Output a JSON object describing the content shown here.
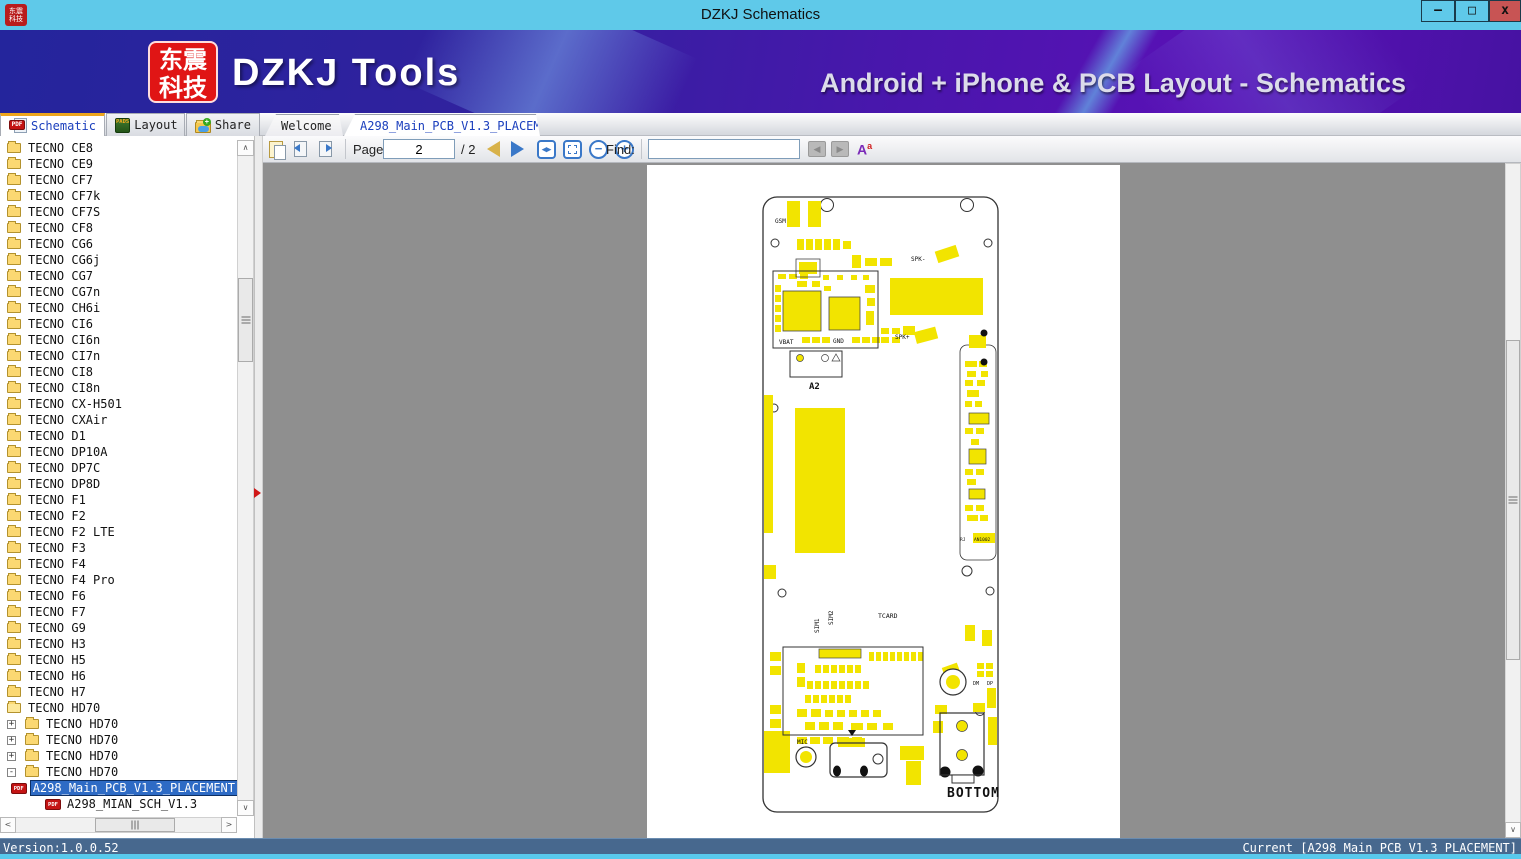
{
  "window": {
    "title": "DZKJ Schematics",
    "logo_line1": "东震",
    "logo_line2": "科技",
    "controls": {
      "minimize": "–",
      "maximize": "□",
      "close": "x"
    }
  },
  "banner": {
    "logo_line1": "东震",
    "logo_line2": "科技",
    "product": "DZKJ Tools",
    "tagline": "Android + iPhone & PCB Layout - Schematics"
  },
  "main_tabs": [
    {
      "label": "Schematic",
      "icon": "pdf-icon",
      "active": true
    },
    {
      "label": "Layout",
      "icon": "pads-icon",
      "active": false
    },
    {
      "label": "Share",
      "icon": "share-folder-icon",
      "active": false
    }
  ],
  "doc_tabs": [
    {
      "label": "Welcome",
      "active": false
    },
    {
      "label": "A298_Main_PCB_V1.3_PLACEMENT",
      "active": true,
      "close_glyph": "×"
    }
  ],
  "toolbar": {
    "page_label": "Page:",
    "page_value": "2",
    "page_total": "/ 2",
    "fit_width_glyph": "◂▸",
    "zoom_out_glyph": "−",
    "zoom_in_glyph": "+",
    "find_label": "Find:",
    "find_value": "",
    "font_glyph": "A",
    "font_sup_glyph": "a"
  },
  "sidebar": {
    "tree": [
      {
        "label": "TECNO CE8"
      },
      {
        "label": "TECNO CE9"
      },
      {
        "label": "TECNO CF7"
      },
      {
        "label": "TECNO CF7k"
      },
      {
        "label": "TECNO CF7S"
      },
      {
        "label": "TECNO CF8"
      },
      {
        "label": "TECNO CG6"
      },
      {
        "label": "TECNO CG6j"
      },
      {
        "label": "TECNO CG7"
      },
      {
        "label": "TECNO CG7n"
      },
      {
        "label": "TECNO CH6i"
      },
      {
        "label": "TECNO CI6"
      },
      {
        "label": "TECNO CI6n"
      },
      {
        "label": "TECNO CI7n"
      },
      {
        "label": "TECNO CI8"
      },
      {
        "label": "TECNO CI8n"
      },
      {
        "label": "TECNO CX-H501"
      },
      {
        "label": "TECNO CXAir"
      },
      {
        "label": "TECNO D1"
      },
      {
        "label": "TECNO DP10A"
      },
      {
        "label": "TECNO DP7C"
      },
      {
        "label": "TECNO DP8D"
      },
      {
        "label": "TECNO F1"
      },
      {
        "label": "TECNO F2"
      },
      {
        "label": "TECNO F2 LTE"
      },
      {
        "label": "TECNO F3"
      },
      {
        "label": "TECNO F4"
      },
      {
        "label": "TECNO F4 Pro"
      },
      {
        "label": "TECNO F6"
      },
      {
        "label": "TECNO F7"
      },
      {
        "label": "TECNO G9"
      },
      {
        "label": "TECNO H3"
      },
      {
        "label": "TECNO H5"
      },
      {
        "label": "TECNO H6"
      },
      {
        "label": "TECNO H7"
      },
      {
        "label": "TECNO HD70",
        "open": true
      },
      {
        "label": "TECNO HD70",
        "level": 1,
        "expander": "+"
      },
      {
        "label": "TECNO HD70",
        "level": 1,
        "expander": "+"
      },
      {
        "label": "TECNO HD70",
        "level": 1,
        "expander": "+"
      },
      {
        "label": "TECNO HD70",
        "level": 1,
        "expander": "-"
      },
      {
        "label": "A298_Main_PCB_V1.3_PLACEMENT",
        "level": 2,
        "type": "pdf",
        "selected": true
      },
      {
        "label": "A298_MIAN_SCH_V1.3",
        "level": 2,
        "type": "pdf"
      }
    ]
  },
  "pcb": {
    "labels": {
      "gsm": "GSM",
      "spk_minus": "SPK-",
      "spk_plus": "SPK+",
      "vbat": "VBAT",
      "gnd": "GND",
      "a2": "A2",
      "an1002": "AN1002",
      "rj": "RJ",
      "sim1": "SIM1",
      "sim2": "SIM2",
      "tcard": "TCARD",
      "dm": "DM",
      "dp": "DP",
      "mic": "MIC",
      "bottom": "BOTTOM"
    }
  },
  "status": {
    "version": "Version:1.0.0.52",
    "current": "Current [A298_Main_PCB_V1.3_PLACEMENT]"
  }
}
